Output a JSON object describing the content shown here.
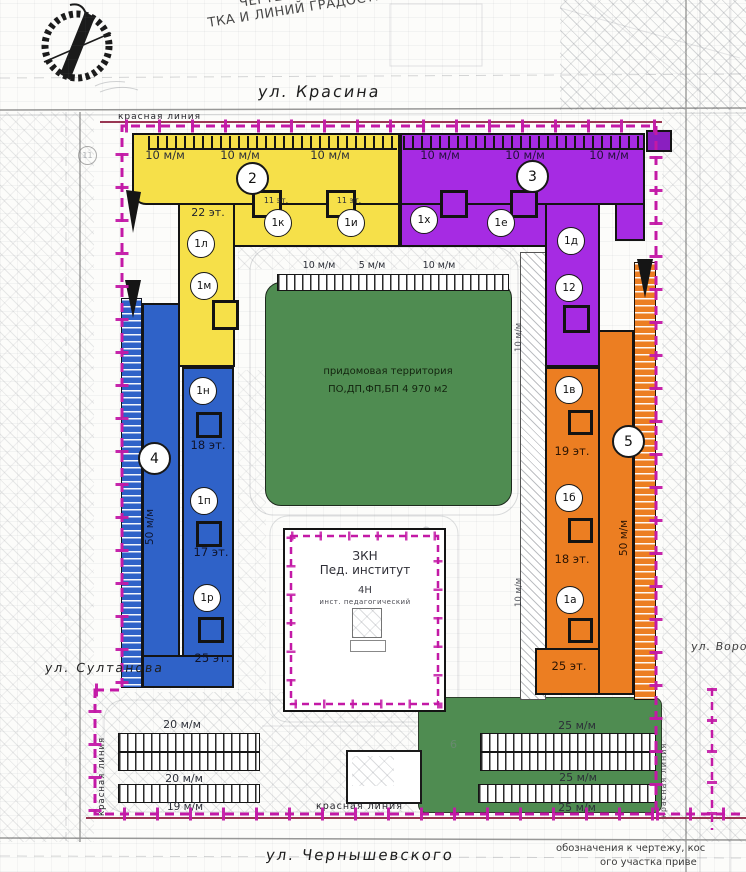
{
  "title": {
    "line1": "ЧЕРТЕЖ ГРАДОСТРОИТЕЛЬНОГО ПЛА",
    "line2": "ТКА И ЛИНИЙ ГРАДОСТРОИТЕЛЬНОГО РЕГ"
  },
  "streets": {
    "top": "ул. Красина",
    "bottom": "ул. Чернышевского",
    "left": "ул. Султанова",
    "right": "ул. Воровского"
  },
  "red_lines": {
    "top": "красная линия",
    "bottom": "красная линия",
    "left": "красная линия",
    "right": "красная линия"
  },
  "courtyard": {
    "line1": "придомовая территория",
    "line2": "ПО,ДП,ФП,БП 4 970 м2"
  },
  "institute": {
    "code": "ЗКН",
    "name": "Пед. институт",
    "block": "4Н",
    "sub": "инст. педагогический"
  },
  "buildings": {
    "b2": {
      "number": "2",
      "tower_floors": "22 эт.",
      "parking_labels": [
        "10 м/м",
        "10 м/м",
        "10 м/м"
      ],
      "sections": {
        "s1l": "1л",
        "s1m": "1м",
        "s1k": "1к",
        "s1i": "1и"
      },
      "section_floors": {
        "s1k": "11 эт.",
        "s1i": "11 эт."
      }
    },
    "b3": {
      "number": "3",
      "parking_labels": [
        "10 м/м",
        "10 м/м",
        "10 м/м"
      ],
      "sections": {
        "s1h": "1х",
        "s1e": "1е",
        "s1d": "1д",
        "s12": "12"
      }
    },
    "b4": {
      "number": "4",
      "side_parking": "50 м/м",
      "sections": {
        "s1n": "1н",
        "s1p": "1п",
        "s1r": "1р"
      },
      "floors": {
        "s1n": "18 эт.",
        "s1p": "17 эт.",
        "s1r": "25 эт."
      }
    },
    "b5": {
      "number": "5",
      "side_parking": "50 м/м",
      "sections": {
        "s1v": "1в",
        "s1b": "1б",
        "s1a": "1а"
      },
      "floors": {
        "s1v": "19 эт.",
        "s1b": "18 эт.",
        "s1a": "25 эт."
      }
    }
  },
  "inner_parking": {
    "top": [
      "10 м/м",
      "5 м/м",
      "10 м/м"
    ],
    "right": [
      "10 м/м",
      "10 м/м"
    ]
  },
  "bottom_parking": {
    "left": [
      "20 м/м",
      "20 м/м",
      "19 м/м"
    ],
    "right": [
      "25 м/м",
      "25 м/м",
      "25 м/м"
    ]
  },
  "corner_note": {
    "line1": "обозначения к чертежу, кос",
    "line2": "ого участка приве"
  },
  "background_numbers": {
    "n17": "17",
    "n16": "16",
    "n15": "15",
    "n14": "14",
    "n12": "12",
    "n11": "11",
    "n6": "6"
  },
  "colors": {
    "yellow": "#F6E049",
    "purple": "#A62BE3",
    "blue": "#2F62C8",
    "orange": "#EC7E22",
    "green": "#4F8C51",
    "magenta": "#C319A6",
    "redline": "#8E2140"
  }
}
